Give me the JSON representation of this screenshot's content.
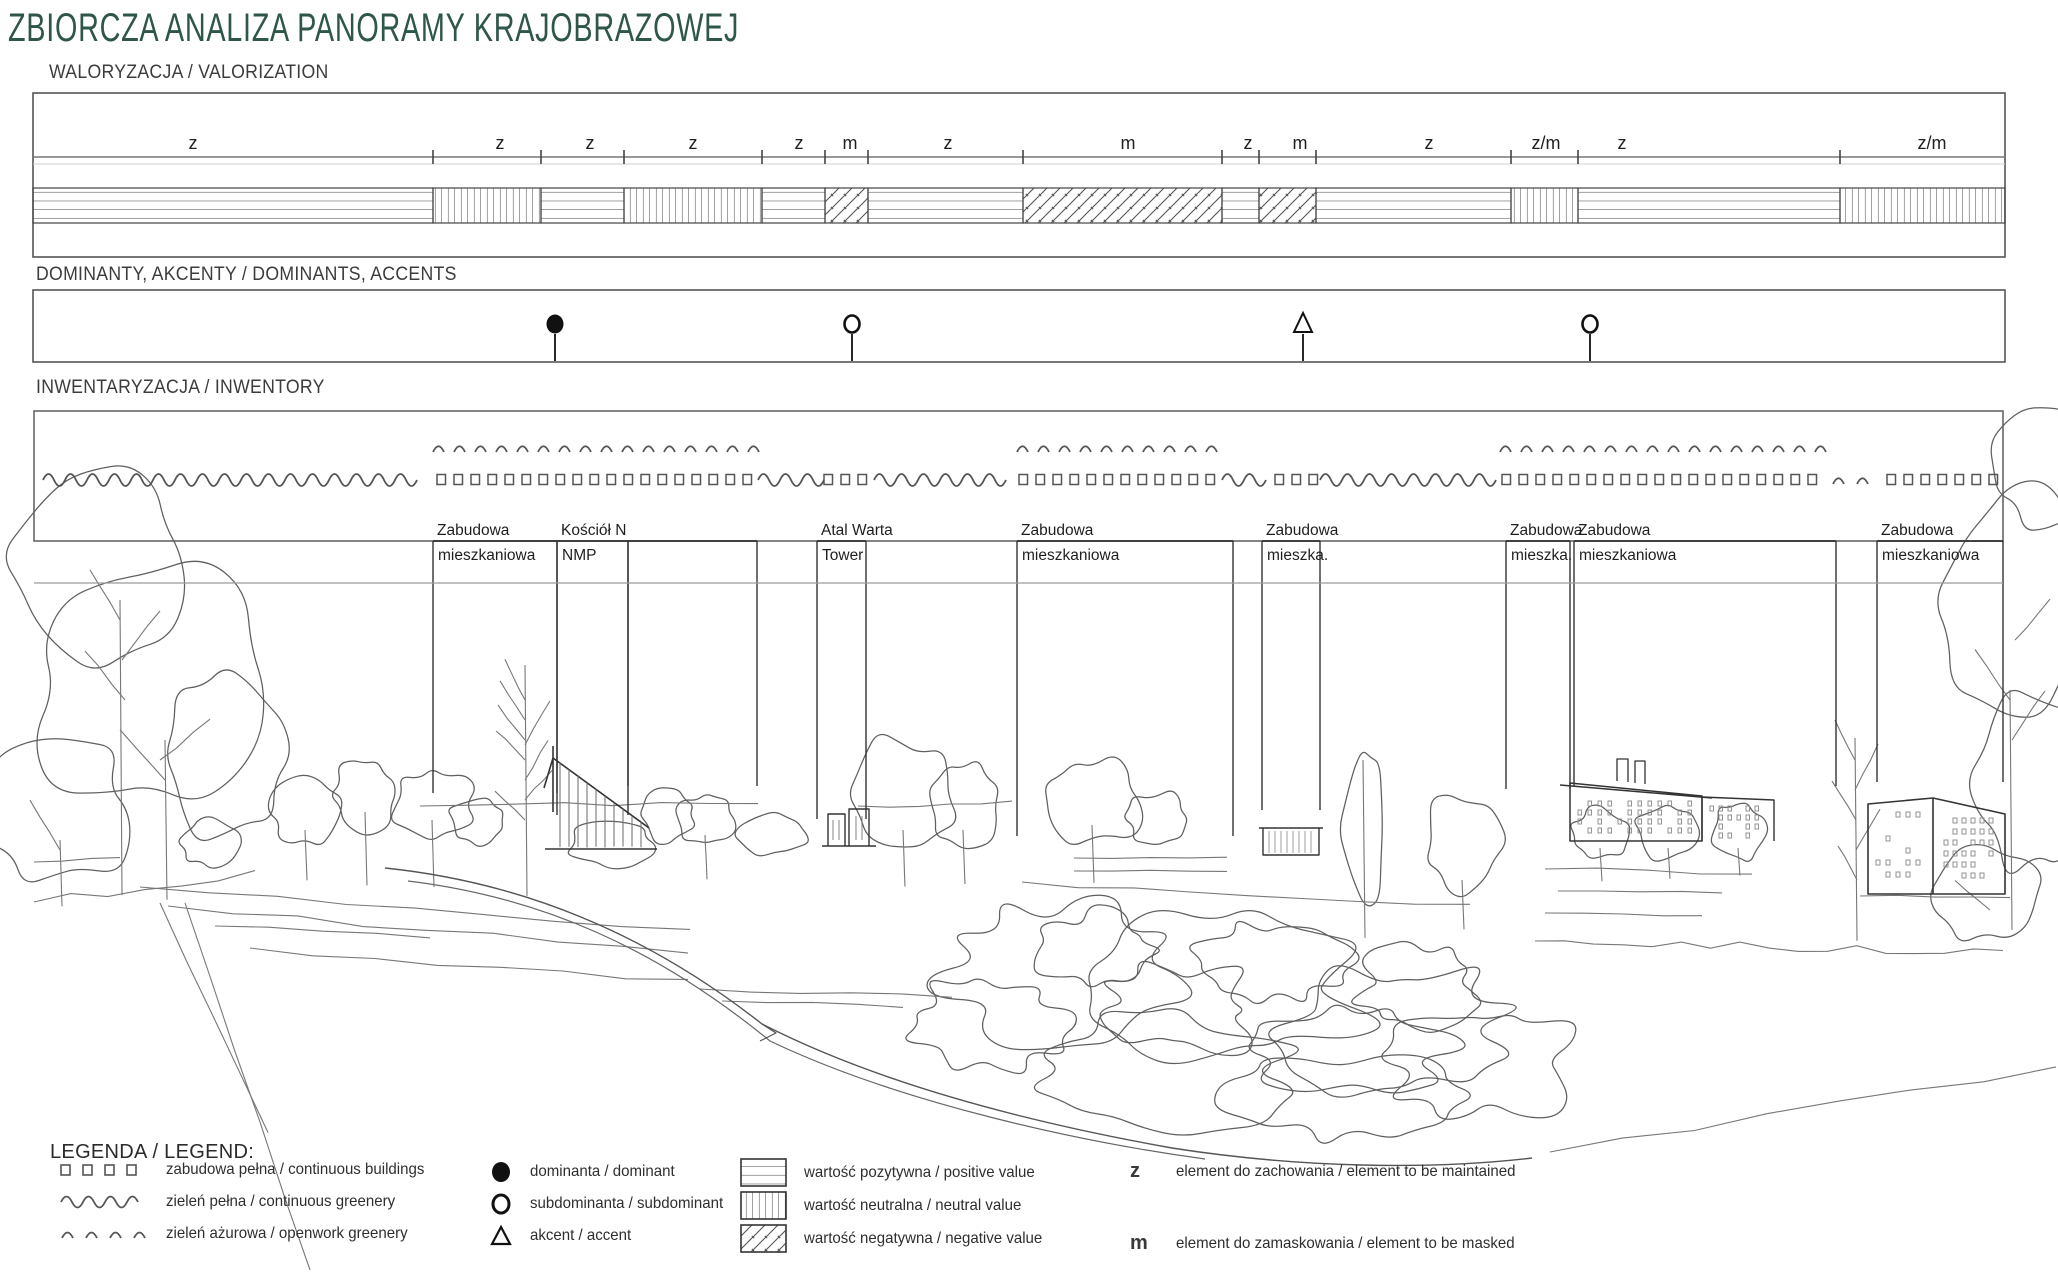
{
  "page": {
    "title": "ZBIORCZA ANALIZA PANORAMY KRAJOBRAZOWEJ",
    "title_color": "#2e564a"
  },
  "sections": {
    "valorization": {
      "label": "WALORYZACJA / VALORIZATION",
      "segments": [
        {
          "from": 33,
          "to": 433,
          "mark": "z",
          "mark_x": 193,
          "value": "positive"
        },
        {
          "from": 433,
          "to": 541,
          "mark": "z",
          "mark_x": 500,
          "value": "neutral"
        },
        {
          "from": 541,
          "to": 624,
          "mark": "z",
          "mark_x": 590,
          "value": "positive"
        },
        {
          "from": 624,
          "to": 762,
          "mark": "z",
          "mark_x": 693,
          "value": "neutral"
        },
        {
          "from": 762,
          "to": 825,
          "mark": "z",
          "mark_x": 799,
          "value": "positive"
        },
        {
          "from": 825,
          "to": 868,
          "mark": "m",
          "mark_x": 850,
          "value": "negative"
        },
        {
          "from": 868,
          "to": 1023,
          "mark": "z",
          "mark_x": 948,
          "value": "positive"
        },
        {
          "from": 1023,
          "to": 1222,
          "mark": "m",
          "mark_x": 1128,
          "value": "negative"
        },
        {
          "from": 1222,
          "to": 1259,
          "mark": "z",
          "mark_x": 1248,
          "value": "positive"
        },
        {
          "from": 1259,
          "to": 1316,
          "mark": "m",
          "mark_x": 1300,
          "value": "negative"
        },
        {
          "from": 1316,
          "to": 1511,
          "mark": "z",
          "mark_x": 1429,
          "value": "positive"
        },
        {
          "from": 1511,
          "to": 1578,
          "mark": "z/m",
          "mark_x": 1546,
          "value": "neutral"
        },
        {
          "from": 1578,
          "to": 1840,
          "mark": "z",
          "mark_x": 1622,
          "value": "positive"
        },
        {
          "from": 1840,
          "to": 2005,
          "mark": "z/m",
          "mark_x": 1932,
          "value": "neutral"
        }
      ]
    },
    "dominants": {
      "label": "DOMINANTY, AKCENTY / DOMINANTS, ACCENTS",
      "symbols": [
        {
          "x": 555,
          "type": "dominant"
        },
        {
          "x": 852,
          "type": "subdominant"
        },
        {
          "x": 1303,
          "type": "accent"
        },
        {
          "x": 1590,
          "type": "subdominant"
        }
      ]
    },
    "inventory": {
      "label": "INWENTARYZACJA / INWENTORY",
      "greenery_open_rows": [
        [
          433,
          758
        ],
        [
          1017,
          1233
        ],
        [
          1500,
          1840
        ]
      ],
      "pattern_row": [
        {
          "from": 43,
          "to": 433,
          "type": "wave"
        },
        {
          "from": 433,
          "to": 758,
          "type": "squares"
        },
        {
          "from": 758,
          "to": 820,
          "type": "wave"
        },
        {
          "from": 820,
          "to": 874,
          "type": "squares"
        },
        {
          "from": 874,
          "to": 1015,
          "type": "wave"
        },
        {
          "from": 1015,
          "to": 1222,
          "type": "squares"
        },
        {
          "from": 1222,
          "to": 1271,
          "type": "wave"
        },
        {
          "from": 1271,
          "to": 1320,
          "type": "squares"
        },
        {
          "from": 1320,
          "to": 1498,
          "type": "wave"
        },
        {
          "from": 1498,
          "to": 1830,
          "type": "squares"
        },
        {
          "from": 1830,
          "to": 1883,
          "type": "caret"
        },
        {
          "from": 1883,
          "to": 2003,
          "type": "squares"
        }
      ],
      "features": [
        {
          "from": 433,
          "to": 557,
          "line1": "Zabudowa",
          "line2": "mieszkaniowa",
          "drop": 793
        },
        {
          "from": 557,
          "to": 628,
          "line1": "Kościół N",
          "line2": "NMP",
          "drop": 815
        },
        {
          "from": 628,
          "to": 757,
          "line1": "",
          "line2": "",
          "drop": 786
        },
        {
          "from": 817,
          "to": 866,
          "line1": "Atal Warta",
          "line2": "Tower",
          "drop": 819
        },
        {
          "from": 1017,
          "to": 1233,
          "line1": "Zabudowa",
          "line2": "mieszkaniowa",
          "drop": 836
        },
        {
          "from": 1262,
          "to": 1320,
          "line1": "Zabudowa",
          "line2": "mieszka.",
          "drop": 810
        },
        {
          "from": 1506,
          "to": 1570,
          "line1": "Zabudowa",
          "line2": "mieszka.",
          "drop": 789
        },
        {
          "from": 1574,
          "to": 1836,
          "line1": "Zabudowa",
          "line2": "mieszkaniowa",
          "drop": 786
        },
        {
          "from": 1877,
          "to": 2003,
          "line1": "Zabudowa",
          "line2": "mieszkaniowa",
          "drop": 782
        }
      ]
    },
    "legend": {
      "title": "LEGENDA / LEGEND:",
      "symbols_col": [
        {
          "icon": "squares-row",
          "label": "zabudowa pełna / continuous buildings"
        },
        {
          "icon": "wave",
          "label": "zieleń pełna / continuous greenery"
        },
        {
          "icon": "caret-row",
          "label": "zieleń ażurowa / openwork greenery"
        }
      ],
      "marks_col": [
        {
          "icon": "filled-circle",
          "label": "dominanta / dominant"
        },
        {
          "icon": "open-circle",
          "label": "subdominanta / subdominant"
        },
        {
          "icon": "triangle",
          "label": "akcent / accent"
        }
      ],
      "values_col": [
        {
          "icon": "hatch-horizontal",
          "label": "wartość pozytywna / positive value"
        },
        {
          "icon": "hatch-vertical",
          "label": "wartość neutralna / neutral value"
        },
        {
          "icon": "hatch-diagonal",
          "label": "wartość negatywna / negative value"
        }
      ],
      "letters_col": [
        {
          "mark": "z",
          "label": "element do zachowania / element to be maintained"
        },
        {
          "mark": "m",
          "label": "element do zamaskowania / element to be masked"
        }
      ]
    }
  }
}
